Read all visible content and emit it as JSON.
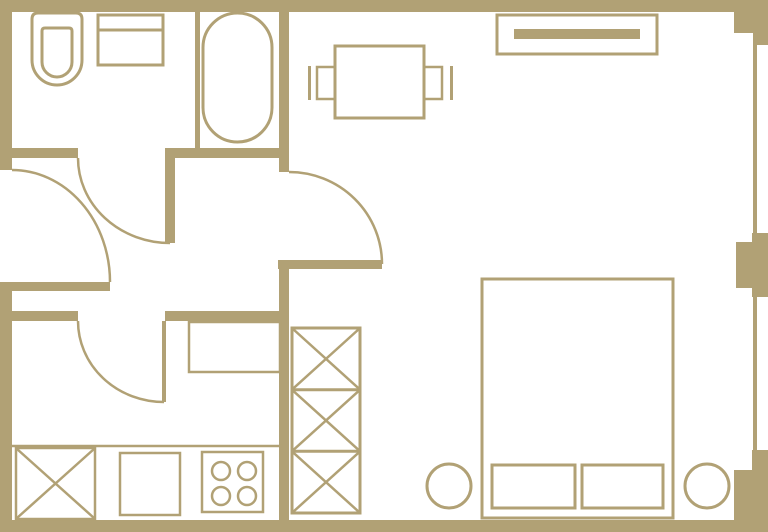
{
  "canvas": {
    "width": 768,
    "height": 532
  },
  "colors": {
    "wall": "#b1a175",
    "background": "#ffffff"
  },
  "plan": {
    "walls": [
      {
        "name": "wall-exterior-top",
        "kind": "wall",
        "x": 0,
        "y": 0,
        "w": 768,
        "h": 12
      },
      {
        "name": "wall-exterior-left-upper",
        "kind": "wall",
        "x": 0,
        "y": 0,
        "w": 12,
        "h": 170
      },
      {
        "name": "wall-exterior-left-lower",
        "kind": "wall",
        "x": 0,
        "y": 282,
        "w": 12,
        "h": 250
      },
      {
        "name": "wall-exterior-bottom",
        "kind": "wall",
        "x": 0,
        "y": 520,
        "w": 768,
        "h": 12
      },
      {
        "name": "wall-pier-top-right",
        "kind": "wall",
        "x": 734,
        "y": 0,
        "w": 34,
        "h": 33
      },
      {
        "name": "wall-pier-top-right-step",
        "kind": "wall",
        "x": 753,
        "y": 33,
        "w": 15,
        "h": 12
      },
      {
        "name": "wall-pier-mid-right-outer",
        "kind": "wall",
        "x": 752,
        "y": 233,
        "w": 16,
        "h": 64
      },
      {
        "name": "wall-pier-mid-right-inner",
        "kind": "wall",
        "x": 736,
        "y": 242,
        "w": 16,
        "h": 46
      },
      {
        "name": "wall-corner-bottom-right-outer",
        "kind": "wall",
        "x": 752,
        "y": 450,
        "w": 16,
        "h": 82
      },
      {
        "name": "wall-corner-bottom-right-inner",
        "kind": "wall",
        "x": 734,
        "y": 470,
        "w": 34,
        "h": 62
      },
      {
        "name": "wall-bathroom-divider",
        "kind": "wall",
        "x": 195,
        "y": 0,
        "w": 5,
        "h": 148
      },
      {
        "name": "wall-bathroom-south-left",
        "kind": "wall",
        "x": 0,
        "y": 148,
        "w": 78,
        "h": 10
      },
      {
        "name": "wall-bathroom-south-right",
        "kind": "wall",
        "x": 165,
        "y": 148,
        "w": 124,
        "h": 10
      },
      {
        "name": "wall-hall-living-upper",
        "kind": "wall",
        "x": 279,
        "y": 0,
        "w": 10,
        "h": 172
      },
      {
        "name": "wall-kitchen-north-left",
        "kind": "wall",
        "x": 0,
        "y": 311,
        "w": 78,
        "h": 10
      },
      {
        "name": "wall-kitchen-north-right",
        "kind": "wall",
        "x": 165,
        "y": 311,
        "w": 124,
        "h": 10
      },
      {
        "name": "wall-kitchen-living-divider",
        "kind": "wall",
        "x": 279,
        "y": 268,
        "w": 10,
        "h": 264
      }
    ],
    "windows": [
      {
        "name": "window-glazing-upper",
        "kind": "wall",
        "x": 753,
        "y": 45,
        "w": 4,
        "h": 188
      },
      {
        "name": "window-glazing-lower",
        "kind": "wall",
        "x": 753,
        "y": 297,
        "w": 4,
        "h": 153
      }
    ],
    "doors": [
      {
        "name": "entry-door-leaf",
        "kind": "bar",
        "x": 12,
        "y": 282,
        "w": 98,
        "h": 9
      },
      {
        "name": "entry-door-swing",
        "kind": "path",
        "d": "M 12 170 A 98 112 0 0 1 110 282",
        "sw": 2.5
      },
      {
        "name": "bathroom-door-leaf",
        "kind": "bar",
        "x": 165,
        "y": 158,
        "w": 10,
        "h": 85
      },
      {
        "name": "bathroom-door-swing",
        "kind": "path",
        "d": "M 78 158 A 92 85 0 0 0 170 243",
        "sw": 2.5
      },
      {
        "name": "kitchen-door-leaf",
        "kind": "bar",
        "x": 162,
        "y": 321,
        "w": 4,
        "h": 81
      },
      {
        "name": "kitchen-door-swing",
        "kind": "path",
        "d": "M 78 321 A 86 81 0 0 0 164 402",
        "sw": 2.5
      },
      {
        "name": "living-door-leaf",
        "kind": "bar",
        "x": 278,
        "y": 260,
        "w": 104,
        "h": 9
      },
      {
        "name": "living-door-swing",
        "kind": "path",
        "d": "M 289 172 A 93 92 0 0 1 382 264",
        "sw": 2.5
      }
    ],
    "bathroom": [
      {
        "name": "toilet-outline",
        "kind": "path",
        "d": "M 38 13 H 76 Q 82 13 82 19 V 60 A 25 25 0 0 1 32 60 V 19 Q 32 13 38 13 Z",
        "sw": 3
      },
      {
        "name": "toilet-bowl",
        "kind": "path",
        "d": "M 45 28 H 69 Q 72 28 72 31 V 62 A 15 15 0 0 1 42 62 V 31 Q 42 28 45 28 Z",
        "sw": 3
      },
      {
        "name": "washbasin",
        "kind": "rect",
        "x": 98,
        "y": 15,
        "w": 65,
        "h": 50,
        "sw": 3
      },
      {
        "name": "washbasin-divider",
        "kind": "line",
        "x1": 98,
        "y1": 30,
        "x2": 163,
        "y2": 30,
        "sw": 3
      },
      {
        "name": "bathtub",
        "kind": "rect",
        "x": 203,
        "y": 13,
        "w": 69,
        "h": 129,
        "rx": 34.5,
        "sw": 3
      }
    ],
    "dining": [
      {
        "name": "dining-table",
        "kind": "rect",
        "x": 335,
        "y": 46,
        "w": 89,
        "h": 72,
        "sw": 3
      },
      {
        "name": "chair-left-seat",
        "kind": "rect",
        "x": 317,
        "y": 67,
        "w": 18,
        "h": 32,
        "sw": 2.5
      },
      {
        "name": "chair-left-back",
        "kind": "bar",
        "x": 308,
        "y": 66,
        "w": 3,
        "h": 34
      },
      {
        "name": "chair-right-seat",
        "kind": "rect",
        "x": 424,
        "y": 67,
        "w": 18,
        "h": 32,
        "sw": 2.5
      },
      {
        "name": "chair-right-back",
        "kind": "bar",
        "x": 450,
        "y": 66,
        "w": 3,
        "h": 34
      }
    ],
    "bedroom": [
      {
        "name": "tv-console",
        "kind": "rect",
        "x": 497,
        "y": 15,
        "w": 160,
        "h": 39,
        "sw": 3
      },
      {
        "name": "tv-console-screen",
        "kind": "bar",
        "x": 514,
        "y": 29,
        "w": 126,
        "h": 10
      },
      {
        "name": "double-bed",
        "kind": "rect",
        "x": 482,
        "y": 279,
        "w": 191,
        "h": 239,
        "sw": 3
      },
      {
        "name": "pillow-left",
        "kind": "rect",
        "x": 492,
        "y": 465,
        "w": 83,
        "h": 43,
        "sw": 3
      },
      {
        "name": "pillow-right",
        "kind": "rect",
        "x": 582,
        "y": 465,
        "w": 81,
        "h": 43,
        "sw": 3
      },
      {
        "name": "bedside-stool-left",
        "kind": "circle",
        "cx": 449,
        "cy": 486,
        "r": 22,
        "sw": 3
      },
      {
        "name": "bedside-stool-right",
        "kind": "circle",
        "cx": 707,
        "cy": 486,
        "r": 22,
        "sw": 3
      }
    ],
    "wardrobe": [
      {
        "name": "wardrobe-outline",
        "kind": "rect",
        "x": 292,
        "y": 328,
        "w": 68,
        "h": 185,
        "sw": 3
      },
      {
        "name": "wardrobe-shelf-divider-upper",
        "kind": "line",
        "x1": 292,
        "y1": 389.7,
        "x2": 360,
        "y2": 389.7,
        "sw": 3
      },
      {
        "name": "wardrobe-shelf-divider-lower",
        "kind": "line",
        "x1": 292,
        "y1": 451.3,
        "x2": 360,
        "y2": 451.3,
        "sw": 3
      },
      {
        "name": "wardrobe-cross-top",
        "kind": "xcell",
        "x": 292,
        "y": 328,
        "w": 68,
        "h": 61.7,
        "sw": 2.5
      },
      {
        "name": "wardrobe-cross-middle",
        "kind": "xcell",
        "x": 292,
        "y": 389.7,
        "w": 68,
        "h": 61.6,
        "sw": 2.5
      },
      {
        "name": "wardrobe-cross-bottom",
        "kind": "xcell",
        "x": 292,
        "y": 451.3,
        "w": 68,
        "h": 61.7,
        "sw": 2.5
      }
    ],
    "kitchen": [
      {
        "name": "kitchen-cabinet",
        "kind": "rect",
        "x": 189,
        "y": 322,
        "w": 91,
        "h": 50,
        "sw": 2.5
      },
      {
        "name": "counter-edge",
        "kind": "line",
        "x1": 12,
        "y1": 446,
        "x2": 283,
        "y2": 446,
        "sw": 2.5
      },
      {
        "name": "washing-machine",
        "kind": "xrect",
        "x": 16,
        "y": 448,
        "w": 79,
        "h": 71,
        "sw": 2.5
      },
      {
        "name": "kitchen-sink-unit",
        "kind": "rect",
        "x": 120,
        "y": 453,
        "w": 60,
        "h": 62,
        "sw": 2.5
      },
      {
        "name": "stove",
        "kind": "rect",
        "x": 202,
        "y": 452,
        "w": 61,
        "h": 60,
        "sw": 2.5
      },
      {
        "name": "stove-burner-1",
        "kind": "circle",
        "cx": 221,
        "cy": 471,
        "r": 9,
        "sw": 2.5
      },
      {
        "name": "stove-burner-2",
        "kind": "circle",
        "cx": 247,
        "cy": 471,
        "r": 9,
        "sw": 2.5
      },
      {
        "name": "stove-burner-3",
        "kind": "circle",
        "cx": 221,
        "cy": 496,
        "r": 9,
        "sw": 2.5
      },
      {
        "name": "stove-burner-4",
        "kind": "circle",
        "cx": 247,
        "cy": 496,
        "r": 9,
        "sw": 2.5
      }
    ]
  }
}
